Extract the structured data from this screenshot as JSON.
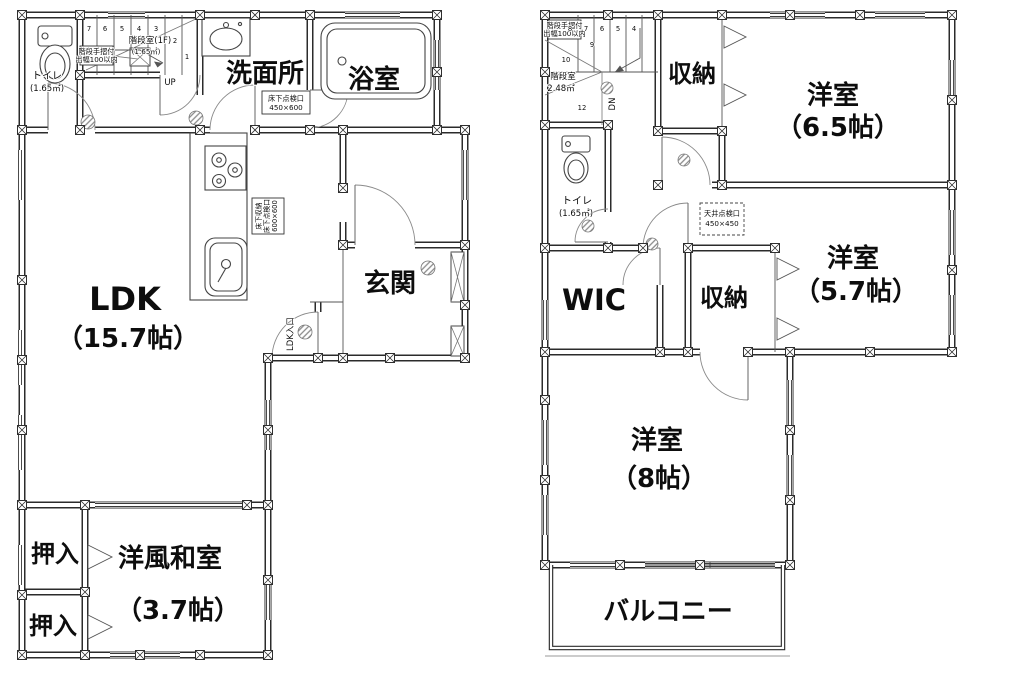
{
  "floor1": {
    "toilet": {
      "label": "トイレ",
      "area": "(1.65㎡)"
    },
    "stairwell": {
      "label": "階段室(1F)",
      "area": "(1.65㎡)",
      "handrail_note_1": "階段手摺付",
      "handrail_note_2": "出幅100以内",
      "direction": "UP",
      "step_numbers": [
        "7",
        "6",
        "5",
        "4",
        "3",
        "2",
        "1"
      ]
    },
    "washroom": {
      "label": "洗面所"
    },
    "bathroom": {
      "label": "浴室"
    },
    "floor_hatch": {
      "line1": "床下点検口",
      "line2": "450×600"
    },
    "underfloor_storage": {
      "line1": "床下収納",
      "line2": "床下点検口",
      "line3": "600×600"
    },
    "ldk": {
      "label": "LDK",
      "area": "（15.7帖）",
      "entry_label": "LDK入口"
    },
    "entrance": {
      "label": "玄関"
    },
    "closet_upper": {
      "label": "押入"
    },
    "closet_lower": {
      "label": "押入"
    },
    "japanese_room": {
      "label": "洋風和室",
      "area": "（3.7帖）"
    }
  },
  "floor2": {
    "stairwell": {
      "label": "階段室",
      "area": "2.48㎡",
      "handrail_note_1": "階段手摺付",
      "handrail_note_2": "出幅100以内",
      "direction": "DN",
      "step_numbers": [
        "8",
        "7",
        "6",
        "5",
        "4"
      ],
      "side_numbers": [
        "9",
        "10",
        "12"
      ]
    },
    "closet_top": {
      "label": "収納"
    },
    "bedroom_65": {
      "label": "洋室",
      "area": "（6.5帖）"
    },
    "toilet": {
      "label": "トイレ",
      "area": "(1.65㎡)"
    },
    "ceiling_hatch": {
      "line1": "天井点検口",
      "line2": "450×450"
    },
    "bedroom_57": {
      "label": "洋室",
      "area": "（5.7帖）"
    },
    "wic": {
      "label": "WIC"
    },
    "closet_mid": {
      "label": "収納"
    },
    "bedroom_8": {
      "label": "洋室",
      "area": "（8帖）"
    },
    "balcony": {
      "label": "バルコニー"
    }
  }
}
